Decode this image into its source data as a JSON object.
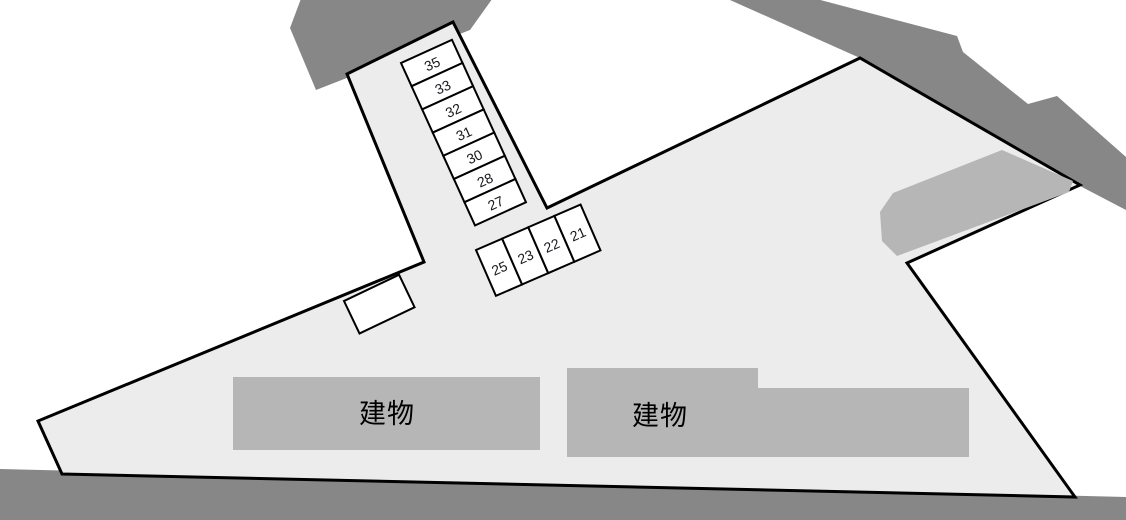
{
  "canvas": {
    "width": 1126,
    "height": 520,
    "background": "#ffffff"
  },
  "colors": {
    "road": "#878787",
    "site_fill": "#ececec",
    "outline": "#000000",
    "building_fill": "#b6b6b6",
    "stall_fill": "#ffffff",
    "stall_stroke": "#000000",
    "number_color": "#16181d",
    "building_label_color": "#000000"
  },
  "roads": [
    {
      "id": "road-top-left",
      "points": [
        [
          305,
          -12
        ],
        [
          290,
          28
        ],
        [
          316,
          90
        ],
        [
          470,
          30
        ],
        [
          500,
          -12
        ]
      ]
    },
    {
      "id": "road-top-right",
      "points": [
        [
          712,
          -8
        ],
        [
          860,
          58
        ],
        [
          1080,
          186
        ],
        [
          1126,
          210
        ],
        [
          1126,
          157
        ],
        [
          1057,
          96
        ],
        [
          1028,
          104
        ],
        [
          963,
          52
        ],
        [
          957,
          36
        ],
        [
          790,
          -8
        ]
      ]
    },
    {
      "id": "road-bottom",
      "points": [
        [
          0,
          469
        ],
        [
          1126,
          497
        ],
        [
          1126,
          520
        ],
        [
          0,
          520
        ]
      ]
    }
  ],
  "site": {
    "points": [
      [
        347,
        74
      ],
      [
        453,
        22
      ],
      [
        547,
        208
      ],
      [
        860,
        58
      ],
      [
        1080,
        185
      ],
      [
        907,
        263
      ],
      [
        1075,
        497
      ],
      [
        62,
        474
      ],
      [
        38,
        421
      ],
      [
        424,
        262
      ]
    ],
    "stroke_width": 3
  },
  "paved_patch": {
    "points": [
      [
        1002,
        150
      ],
      [
        1073,
        181
      ],
      [
        1069,
        192
      ],
      [
        897,
        256
      ],
      [
        882,
        241
      ],
      [
        880,
        212
      ],
      [
        893,
        193
      ]
    ]
  },
  "buildings": [
    {
      "label": "建物",
      "points": [
        [
          233,
          377
        ],
        [
          540,
          377
        ],
        [
          540,
          450
        ],
        [
          233,
          450
        ]
      ],
      "label_x": 387,
      "label_y": 414
    },
    {
      "label": "建物",
      "points": [
        [
          567,
          368
        ],
        [
          758,
          368
        ],
        [
          758,
          388
        ],
        [
          969,
          388
        ],
        [
          969,
          457
        ],
        [
          567,
          457
        ]
      ],
      "label_x": 660,
      "label_y": 416
    }
  ],
  "building_label_font_size": 27,
  "stall_number_font_size": 14,
  "stall_stroke_width": 2,
  "stall_groups": [
    {
      "id": "stall-column-35-27",
      "layout": "column",
      "x": 401,
      "y": 63,
      "rotation": -24.5,
      "stall_width": 56,
      "stall_height": 25.5,
      "numbers": [
        "35",
        "33",
        "32",
        "31",
        "30",
        "28",
        "27"
      ]
    },
    {
      "id": "stall-row-25-21",
      "layout": "row",
      "x": 476,
      "y": 250,
      "rotation": -23.5,
      "stall_width": 28.5,
      "stall_height": 50,
      "numbers": [
        "25",
        "23",
        "22",
        "21"
      ]
    }
  ],
  "unmarked_stall": {
    "x": 344,
    "y": 301,
    "rotation": -25.5,
    "width": 61,
    "height": 36
  }
}
